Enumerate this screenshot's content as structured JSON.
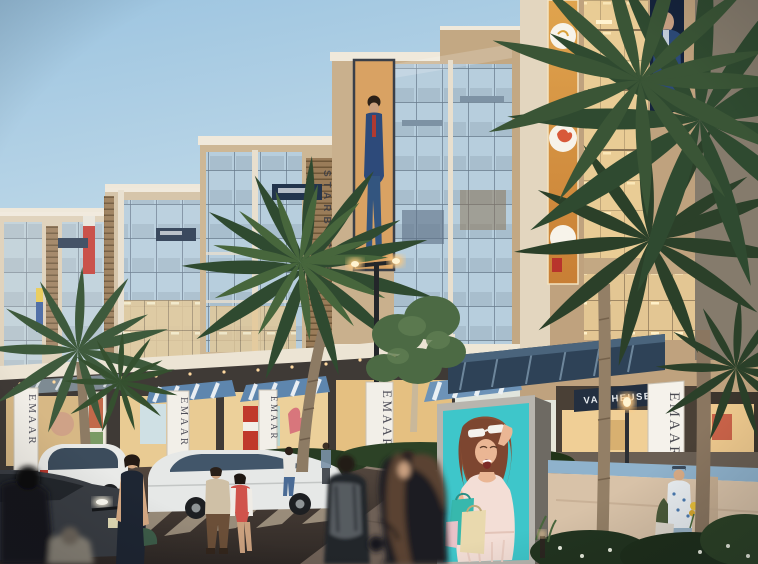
{
  "scene": {
    "description": "Architectural render of a retail boulevard at dusk: beige mixed-use buildings with glass facades, palm trees, shoppers, cars, and a billboard of an excited woman with shopping bags",
    "signs": {
      "emaar": "EMAAR",
      "van_heusen": "VAN HEUSEN",
      "vertical_sign": "STARBUCKS"
    },
    "billboard": {
      "description": "Excited woman lifting white sunglasses, holding teal and cream shopping bags",
      "bg_color": "#3EC6CA"
    },
    "colors": {
      "sky_top": "#A3C9E3",
      "sky_low": "#E4E6DC",
      "facade_tan": "#C8AC8C",
      "facade_cream": "#E6DCC9",
      "sign_navy": "#232F40",
      "awning_navy": "#2E4257",
      "stripe_blue": "#5E86AE",
      "billboard_teal": "#3EC6CA",
      "palm_green": "#33502F",
      "road_dark": "#433A34",
      "banner_white": "#F2EFE8",
      "emaar_text": "#50505A",
      "dress_red": "#D0534B",
      "warm_light": "#F2CE97"
    }
  }
}
